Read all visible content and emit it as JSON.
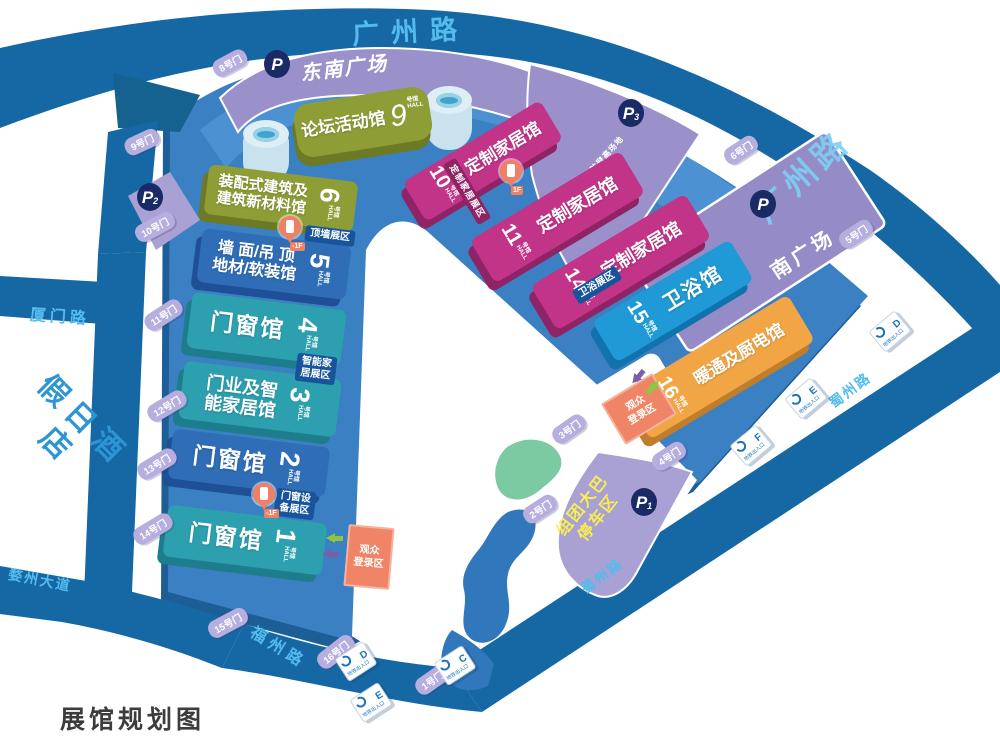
{
  "title": "展馆规划图",
  "roads": {
    "guangzhou_top": "广州路",
    "guangzhou_right": "广州路",
    "xiamen": "厦门路",
    "wuzhou": "婺州大道",
    "fuzhou": "福州路",
    "shuzhou_upper": "蜀州路",
    "shuzhou_lower": "蜀州路"
  },
  "hotel": "假日酒店",
  "squares": {
    "southeast": "东南广场",
    "south": "南广场",
    "fire_zone": "消防登高场地",
    "bus_line1": "组团大巴",
    "bus_line2": "停车区"
  },
  "parking": {
    "letter": "P",
    "p1_sub": "1",
    "p2_sub": "2",
    "p3_sub": "3"
  },
  "suffix": {
    "cn": "号馆",
    "en": "HALL"
  },
  "halls": {
    "h1": {
      "num": "1",
      "line1": "门窗馆"
    },
    "h2": {
      "num": "2",
      "line1": "门窗馆"
    },
    "h3": {
      "num": "3",
      "line1": "门业及智",
      "line2": "能家居馆"
    },
    "h4": {
      "num": "4",
      "line1": "门窗馆"
    },
    "h5": {
      "num": "5",
      "line1": "墙 面/吊 顶",
      "line2": "地材/软装馆"
    },
    "h6": {
      "num": "6",
      "line1": "装配式建筑及",
      "line2": "建筑新材料馆"
    },
    "h9": {
      "num": "9",
      "line1": "论坛活动馆"
    },
    "h10": {
      "num": "10",
      "line1": "定制家居馆"
    },
    "h11": {
      "num": "11",
      "line1": "定制家居馆"
    },
    "h14": {
      "num": "14",
      "line1": "定制家居馆"
    },
    "h15": {
      "num": "15",
      "line1": "卫浴馆"
    },
    "h16": {
      "num": "16",
      "line1": "暖通及厨电馆"
    }
  },
  "zones": {
    "top_wall": "顶墙展区",
    "smart1": "智能家",
    "smart2": "居展区",
    "equip1": "门窗设",
    "equip2": "备展区",
    "custom": "定制家居展区",
    "bath": "卫浴展区"
  },
  "registration": {
    "line1": "观众",
    "line2": "登录区"
  },
  "gates": {
    "g1": "1号门",
    "g2": "2号门",
    "g3": "3号门",
    "g4": "4号门",
    "g5": "5号门",
    "g6": "6号门",
    "g8": "8号门",
    "g9": "9号门",
    "g10": "10号门",
    "g11": "11号门",
    "g12": "12号门",
    "g13": "13号门",
    "g14": "14号门",
    "g15": "15号门",
    "g16": "16号门"
  },
  "metro": {
    "sign": "地铁出入口",
    "bottom": [
      "D",
      "E",
      "C"
    ],
    "right": [
      "F",
      "E",
      "D"
    ]
  },
  "pins": {
    "a": "-1F",
    "b": "1F",
    "c": "-1F"
  },
  "colors": {
    "road": "#1568A4",
    "plot": "#3A80C2",
    "lavender": "#9A91CB",
    "olive": "#8F9D37",
    "hall_blue": "#2F6DB6",
    "teal": "#2DA0AF",
    "magenta": "#C23488",
    "bright_blue": "#1F9AD6",
    "orange": "#F2A544",
    "salmon": "#EF8466",
    "yellow_text": "#F7EE53",
    "road_text": "#54BCEC"
  }
}
